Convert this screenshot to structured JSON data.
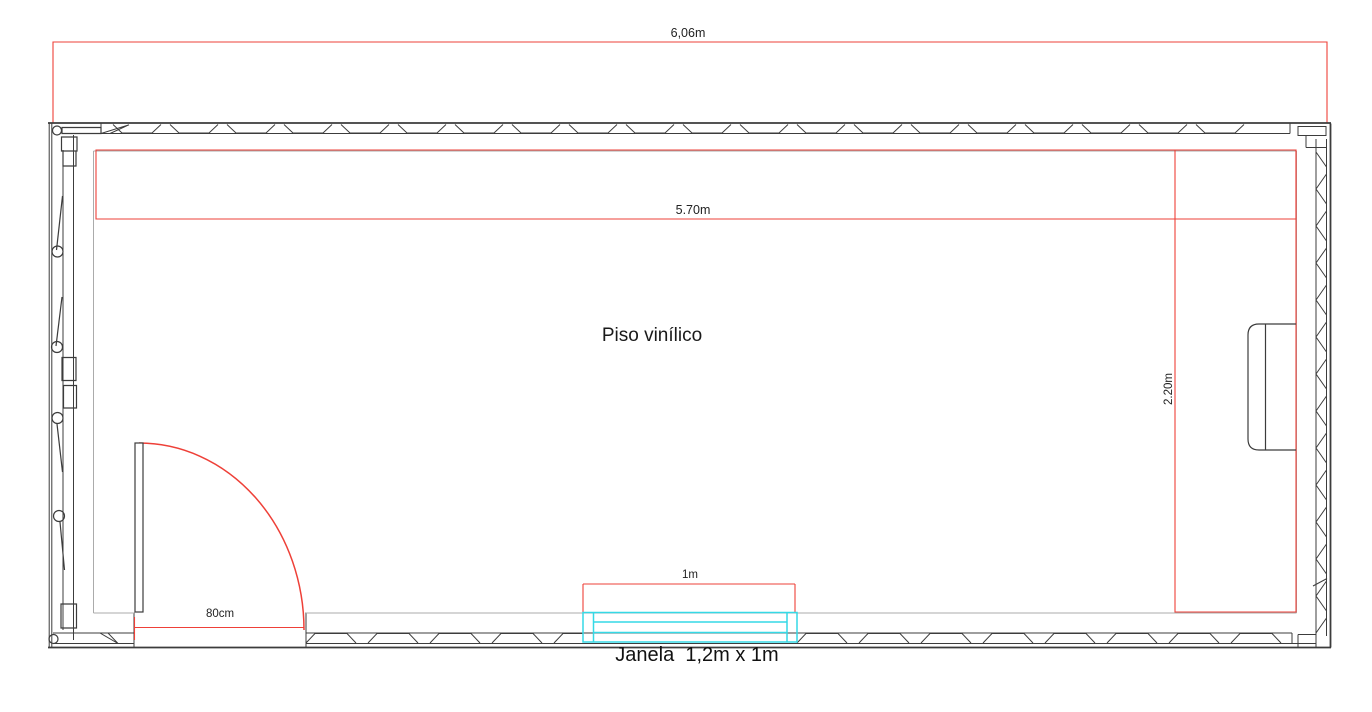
{
  "labels": {
    "overall_width": "6,06m",
    "interior_width": "5.70m",
    "interior_depth": "2.20m",
    "door_width": "80cm",
    "window_width": "1m",
    "window_caption": "Janela  1,2m x 1m",
    "floor_material": "Piso vinílico"
  },
  "colors": {
    "dimension_red": "#ee4038",
    "window_cyan": "#35d9e6",
    "wall_dark": "#3c3c3c",
    "interior_gray": "#ababab"
  }
}
